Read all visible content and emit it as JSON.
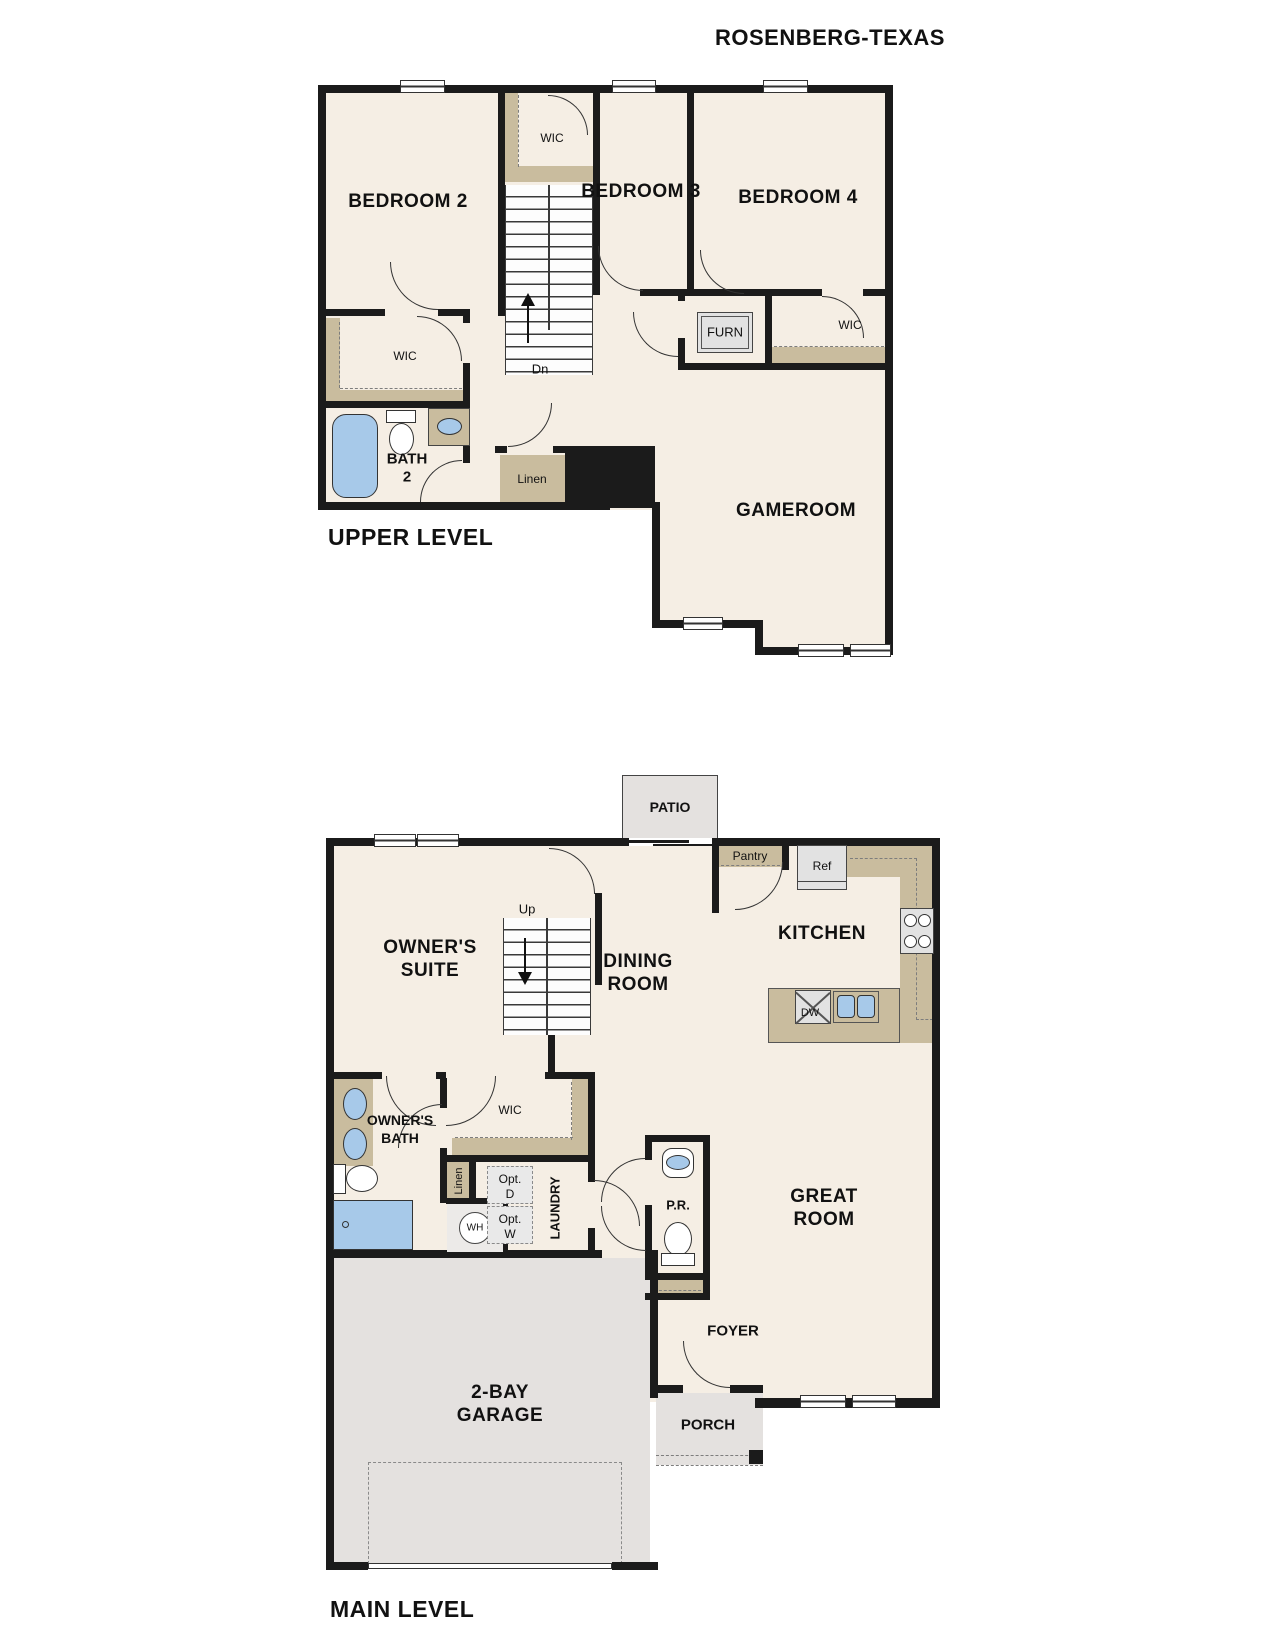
{
  "title": "ROSENBERG-TEXAS",
  "colors": {
    "wall": "#1b1b1b",
    "room_fill": "#f5eee4",
    "closet_counter_tan": "#c9bc9e",
    "concrete_gray": "#e4e1df",
    "fixture_blue": "#a7c9e9",
    "text": "#111111"
  },
  "upper": {
    "caption": "UPPER LEVEL",
    "bedroom2": "BEDROOM 2",
    "bedroom3": "BEDROOM 3",
    "bedroom4": "BEDROOM 4",
    "wic_stair": "WIC",
    "wic_bed2": "WIC",
    "wic_bed4": "WIC",
    "furn": "FURN",
    "bath_l1": "BATH",
    "bath_l2": "2",
    "linen": "Linen",
    "gameroom": "GAMEROOM",
    "dn": "Dn"
  },
  "main": {
    "caption": "MAIN LEVEL",
    "patio": "PATIO",
    "suite_l1": "OWNER'S",
    "suite_l2": "SUITE",
    "up": "Up",
    "dining_l1": "DINING",
    "dining_l2": "ROOM",
    "kitchen": "KITCHEN",
    "pantry": "Pantry",
    "ref": "Ref",
    "dw": "DW",
    "obath_l1": "OWNER'S",
    "obath_l2": "BATH",
    "wic": "WIC",
    "linen": "Linen",
    "optd_l1": "Opt.",
    "optd_l2": "D",
    "optw_l1": "Opt.",
    "optw_l2": "W",
    "laundry": "LAUNDRY",
    "pr": "P.R.",
    "great_l1": "GREAT",
    "great_l2": "ROOM",
    "wh": "WH",
    "garage_l1": "2-BAY",
    "garage_l2": "GARAGE",
    "foyer": "FOYER",
    "porch": "PORCH"
  }
}
